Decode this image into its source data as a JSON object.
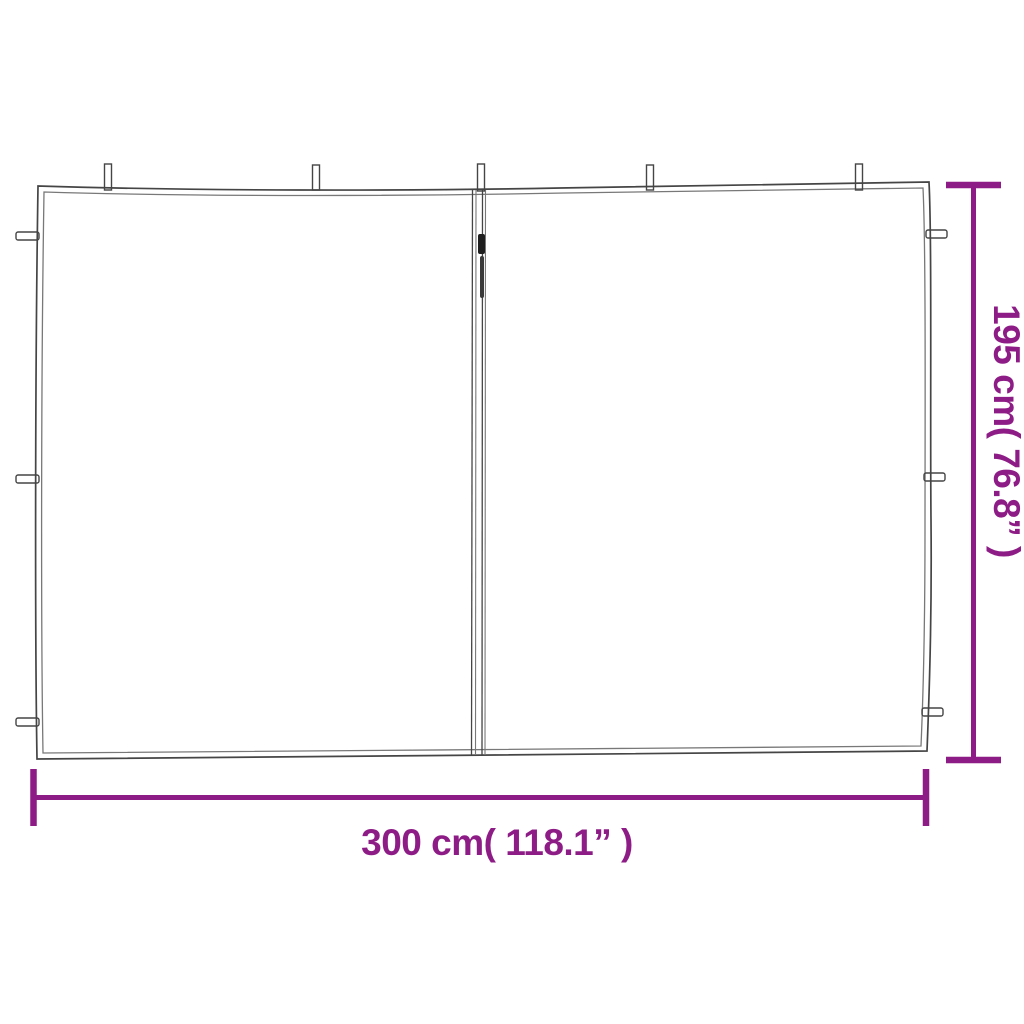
{
  "labels": {
    "width": "300 cm( 118.1” )",
    "height": "195 cm( 76.8” )"
  },
  "colors": {
    "dimension_accent": "#8E1C86",
    "outline": "#454545",
    "background": "#FFFFFF"
  }
}
